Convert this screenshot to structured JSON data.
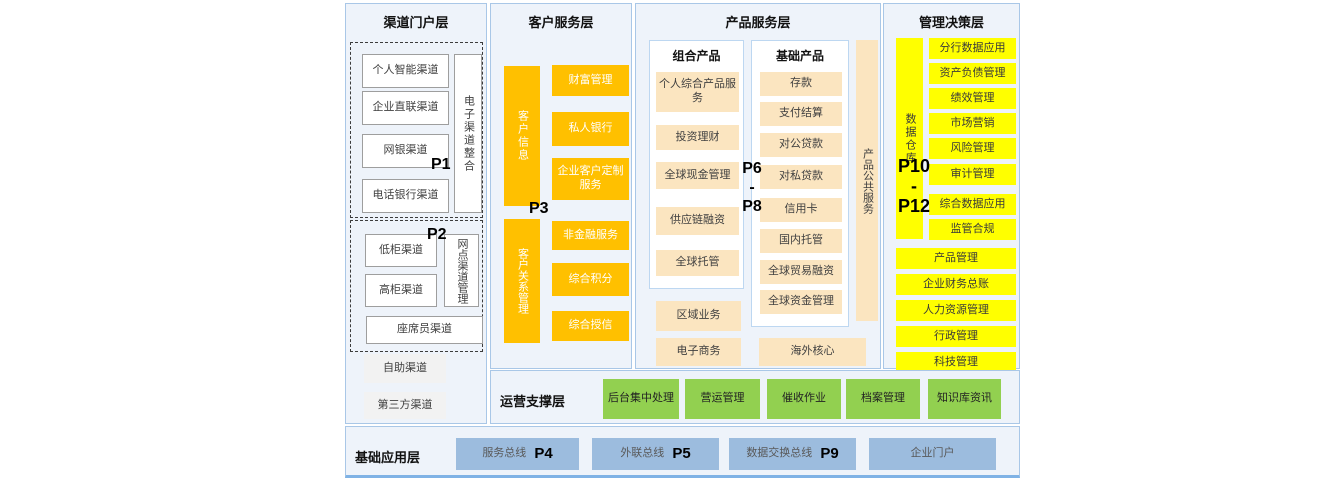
{
  "channel": {
    "title": "渠道门户层",
    "g1": {
      "p": "P1",
      "items": [
        "个人智能渠道",
        "企业直联渠道",
        "网银渠道",
        "电话银行渠道"
      ],
      "bar": "电子渠道整合"
    },
    "g2": {
      "p": "P2",
      "items": [
        "低柜渠道",
        "高柜渠道"
      ],
      "bar": "网点渠道管理",
      "wide": "座席员渠道"
    },
    "extra": [
      "自助渠道",
      "第三方渠道"
    ]
  },
  "customer": {
    "title": "客户服务层",
    "p": "P3",
    "bar1": "客户信息",
    "items1": [
      "财富管理",
      "私人银行",
      "企业客户定制服务"
    ],
    "bar2": "客户关系管理",
    "items2": [
      "非金融服务",
      "综合积分",
      "综合授信"
    ]
  },
  "product": {
    "title": "产品服务层",
    "p": [
      "P6",
      "-",
      "P8"
    ],
    "combo": {
      "title": "组合产品",
      "items": [
        "个人综合产品服务",
        "投资理财",
        "全球现金管理",
        "供应链融资",
        "全球托管"
      ]
    },
    "basic": {
      "title": "基础产品",
      "items": [
        "存款",
        "支付结算",
        "对公贷款",
        "对私贷款",
        "信用卡",
        "国内托管",
        "全球贸易融资",
        "全球资金管理"
      ]
    },
    "sidebar": "产品公共服务",
    "extra_left": [
      "区域业务",
      "电子商务"
    ],
    "extra_right": "海外核心"
  },
  "management": {
    "title": "管理决策层",
    "p": [
      "P10",
      "-",
      "P12"
    ],
    "sidebar": "数据仓库",
    "narrow": [
      "分行数据应用",
      "资产负债管理",
      "绩效管理",
      "市场营销",
      "风险管理",
      "审计管理",
      "综合数据应用",
      "监管合规"
    ],
    "wide": [
      "产品管理",
      "企业财务总账",
      "人力资源管理",
      "行政管理",
      "科技管理"
    ]
  },
  "ops": {
    "title": "运营支撑层",
    "items": [
      "后台集中处理",
      "营运管理",
      "催收作业",
      "档案管理",
      "知识库资讯"
    ]
  },
  "base": {
    "title": "基础应用层",
    "items": [
      {
        "label": "服务总线",
        "p": "P4"
      },
      {
        "label": "外联总线",
        "p": "P5"
      },
      {
        "label": "数据交换总线",
        "p": "P9"
      },
      {
        "label": "企业门户"
      }
    ]
  },
  "colors": {
    "orange": "#FFC000",
    "cream": "#FBE5C0",
    "yellow": "#FFFF00",
    "green": "#92D050",
    "blue": "#9CBCDE",
    "panel_bg": "#EEF3FA",
    "panel_border": "#A9C7E7"
  }
}
